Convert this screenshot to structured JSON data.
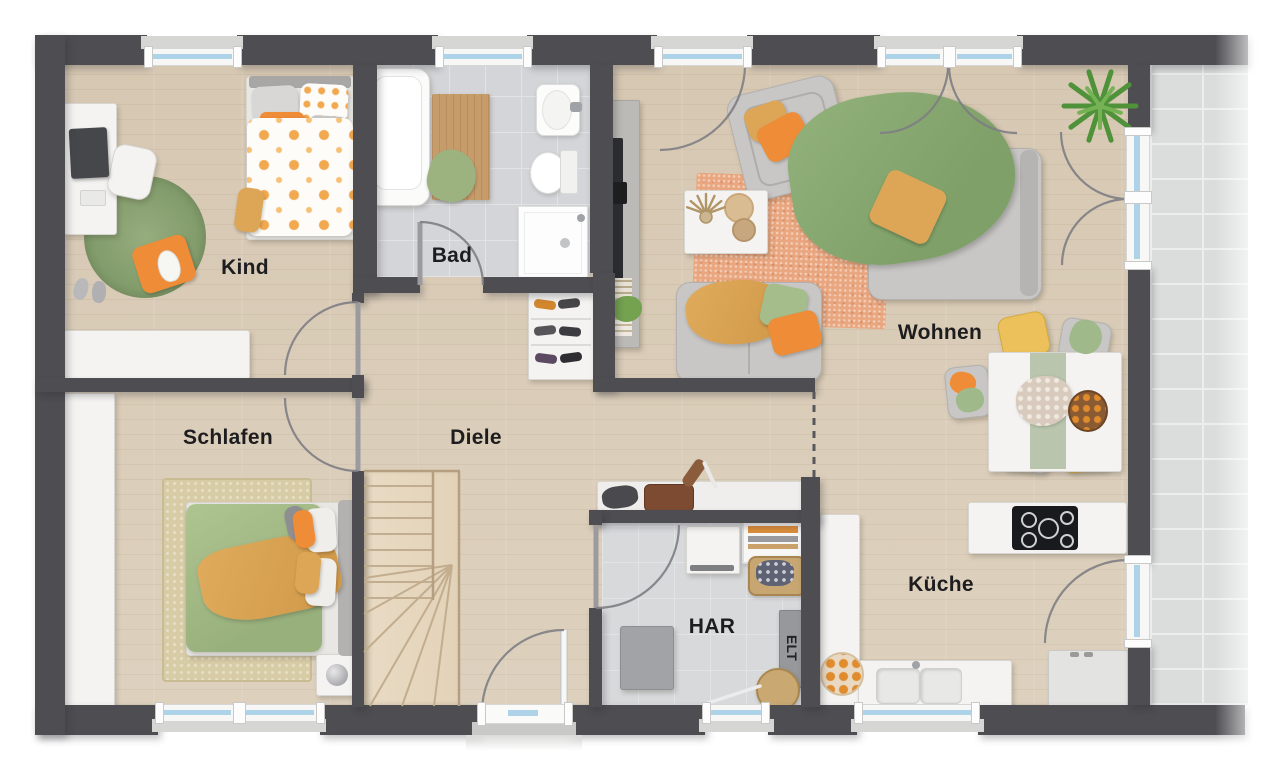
{
  "plan_type": "floor-plan-top-view",
  "rooms": [
    {
      "id": "kind",
      "label": "Kind"
    },
    {
      "id": "bad",
      "label": "Bad"
    },
    {
      "id": "wohnen",
      "label": "Wohnen"
    },
    {
      "id": "schlafen",
      "label": "Schlafen"
    },
    {
      "id": "diele",
      "label": "Diele"
    },
    {
      "id": "har",
      "label": "HAR"
    },
    {
      "id": "elt",
      "label": "ELT"
    },
    {
      "id": "kueche",
      "label": "Küche"
    }
  ],
  "palette": {
    "wall": "#4d4d52",
    "floor_wood": "#dbceba",
    "floor_tile": "#d4d5d8",
    "terrace_tile": "#dbdcdc",
    "window_glass": "#aed3e8",
    "accent_orange": "#ee8c38",
    "accent_mustard": "#dda657",
    "accent_green": "#a5bd8b",
    "rug_salmon": "#e9a67f",
    "rug_green": "#8fa878",
    "chair_yellow": "#ecc05a",
    "outside": "#ffffff"
  }
}
